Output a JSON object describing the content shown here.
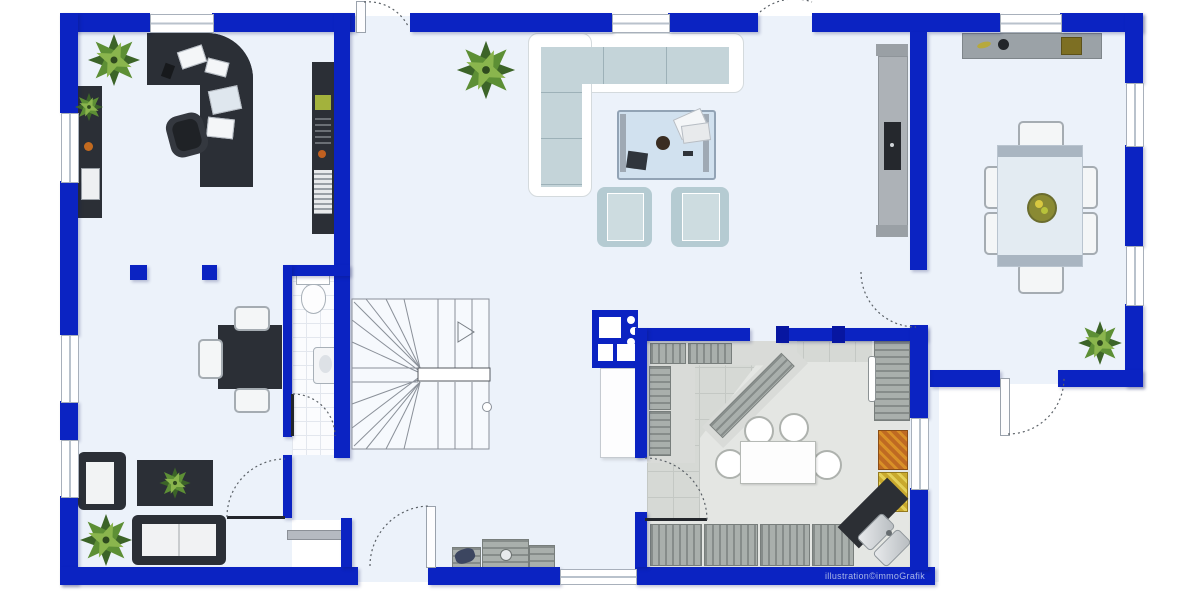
{
  "watermark": {
    "text": "illustration©immoGrafik"
  },
  "colors": {
    "wall": "#0b23c2",
    "wall_dark": "#0716a1",
    "floor": "#ecf2fa",
    "outside": "#ffffff",
    "tile": "#d6d9d5",
    "tile_line": "#c4c8c4",
    "counter_light": "#e4e6e3",
    "worktop": "#d9dbd8",
    "stripe_a": "#868c8a",
    "stripe_b": "#a9afac",
    "dark": "#2b2f36",
    "sofa_cushion": "#c4d4d9",
    "seam": "#9db1b8",
    "armchair": "#b5cbd2",
    "armchair_inner": "#cddce0",
    "chair": "#f4f6f7",
    "chair_border": "#a5acb2",
    "dtable": "#e3ebf2",
    "dtable_edge": "#a9b5c1",
    "plant_dark": "#3c6428",
    "plant_mid": "#5d8f35",
    "plant_light": "#8ab54d",
    "glass": "#cfe0ef",
    "metal_a": "#e9ebed",
    "metal_b": "#b7bcc0",
    "crate_orange": "#bf6a22",
    "crate_yellow": "#c9a92e",
    "watermark_color": "#a9b6e6",
    "arc_line": "#5a6066",
    "stair_line": "#8a9099"
  },
  "furniture": [
    "office-desk",
    "office-chair",
    "office-shelf",
    "sideboard",
    "square-table",
    "dark-armchair",
    "dark-coffee-table",
    "dark-sofa",
    "wc-toilet",
    "wc-sink",
    "staircase",
    "utility-unit",
    "tall-cabinet",
    "corner-sofa",
    "glass-coffee-table",
    "lounge-chair",
    "tv-unit",
    "dining-sideboard",
    "dining-table",
    "dining-chair",
    "kitchen-counter",
    "kitchen-island",
    "bar-stool",
    "fridge",
    "fruit-crate",
    "cooktop",
    "corner-sink",
    "shoe-cabinet",
    "plant"
  ]
}
